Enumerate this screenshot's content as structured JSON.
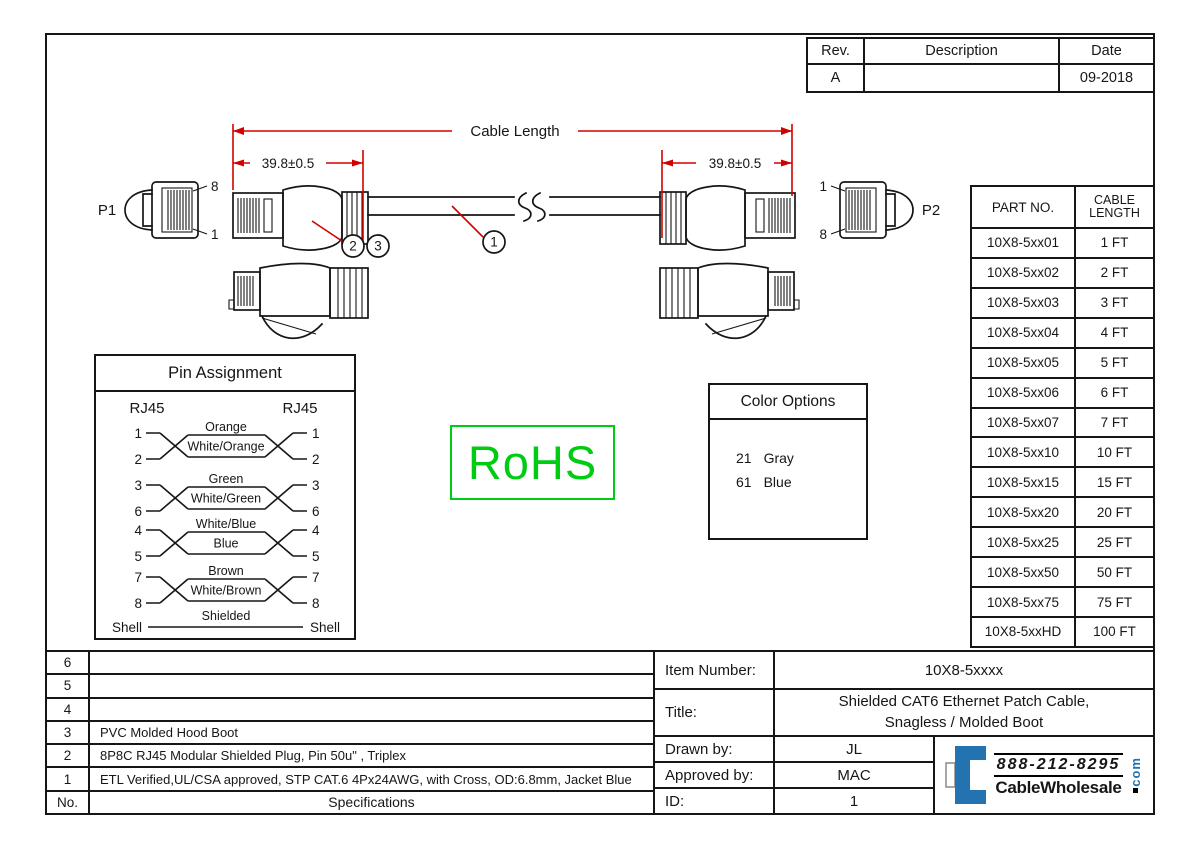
{
  "rev_table": {
    "headers": [
      "Rev.",
      "Description",
      "Date"
    ],
    "row": {
      "rev": "A",
      "description": "",
      "date": "09-2018"
    }
  },
  "drawing": {
    "cable_length_label": "Cable Length",
    "dim_left": "39.8±0.5",
    "dim_right": "39.8±0.5",
    "p1_label": "P1",
    "p2_label": "P2",
    "p1_pin_top": "8",
    "p1_pin_bottom": "1",
    "p2_pin_top": "1",
    "p2_pin_bottom": "8",
    "callout_boot": "2",
    "callout_plug": "3",
    "callout_cable": "1"
  },
  "pin_assignment": {
    "title": "Pin Assignment",
    "left_header": "RJ45",
    "right_header": "RJ45",
    "pairs": [
      {
        "pins": [
          "1",
          "2"
        ],
        "top": "Orange",
        "bottom": "White/Orange"
      },
      {
        "pins": [
          "3",
          "6"
        ],
        "top": "Green",
        "bottom": "White/Green"
      },
      {
        "pins": [
          "4",
          "5"
        ],
        "top": "White/Blue",
        "bottom": "Blue"
      },
      {
        "pins": [
          "7",
          "8"
        ],
        "top": "Brown",
        "bottom": "White/Brown"
      }
    ],
    "shell": {
      "left": "Shell",
      "label": "Shielded",
      "right": "Shell"
    }
  },
  "rohs_label": "RoHS",
  "color_options": {
    "title": "Color Options",
    "options": [
      {
        "code": "21",
        "name": "Gray"
      },
      {
        "code": "61",
        "name": "Blue"
      }
    ]
  },
  "part_table": {
    "headers": [
      "PART NO.",
      "CABLE LENGTH"
    ],
    "rows": [
      [
        "10X8-5xx01",
        "1 FT"
      ],
      [
        "10X8-5xx02",
        "2 FT"
      ],
      [
        "10X8-5xx03",
        "3 FT"
      ],
      [
        "10X8-5xx04",
        "4 FT"
      ],
      [
        "10X8-5xx05",
        "5 FT"
      ],
      [
        "10X8-5xx06",
        "6 FT"
      ],
      [
        "10X8-5xx07",
        "7 FT"
      ],
      [
        "10X8-5xx10",
        "10 FT"
      ],
      [
        "10X8-5xx15",
        "15 FT"
      ],
      [
        "10X8-5xx20",
        "20 FT"
      ],
      [
        "10X8-5xx25",
        "25 FT"
      ],
      [
        "10X8-5xx50",
        "50 FT"
      ],
      [
        "10X8-5xx75",
        "75 FT"
      ],
      [
        "10X8-5xxHD",
        "100 FT"
      ]
    ]
  },
  "spec_table": {
    "rows": [
      {
        "no": "6",
        "text": ""
      },
      {
        "no": "5",
        "text": ""
      },
      {
        "no": "4",
        "text": ""
      },
      {
        "no": "3",
        "text": "PVC Molded Hood Boot"
      },
      {
        "no": "2",
        "text": "8P8C RJ45 Modular Shielded Plug, Pin 50u\" , Triplex"
      },
      {
        "no": "1",
        "text": "ETL Verified,UL/CSA approved, STP CAT.6 4Px24AWG, with Cross, OD:6.8mm, Jacket Blue"
      }
    ],
    "footer": {
      "no_label": "No.",
      "spec_label": "Specifications"
    }
  },
  "title_block": {
    "item_number_label": "Item Number:",
    "item_number": "10X8-5xxxx",
    "title_label": "Title:",
    "title_line1": "Shielded CAT6 Ethernet Patch Cable,",
    "title_line2": "Snagless / Molded Boot",
    "drawn_by_label": "Drawn by:",
    "drawn_by": "JL",
    "approved_by_label": "Approved by:",
    "approved_by": "MAC",
    "id_label": "ID:",
    "id": "1"
  },
  "logo": {
    "phone": "888-212-8295",
    "name": "CableWholesale",
    "tld": "com"
  },
  "colors": {
    "dimension_red": "#d40000",
    "rohs_green": "#00cc14",
    "logo_blue": "#2273b0"
  }
}
